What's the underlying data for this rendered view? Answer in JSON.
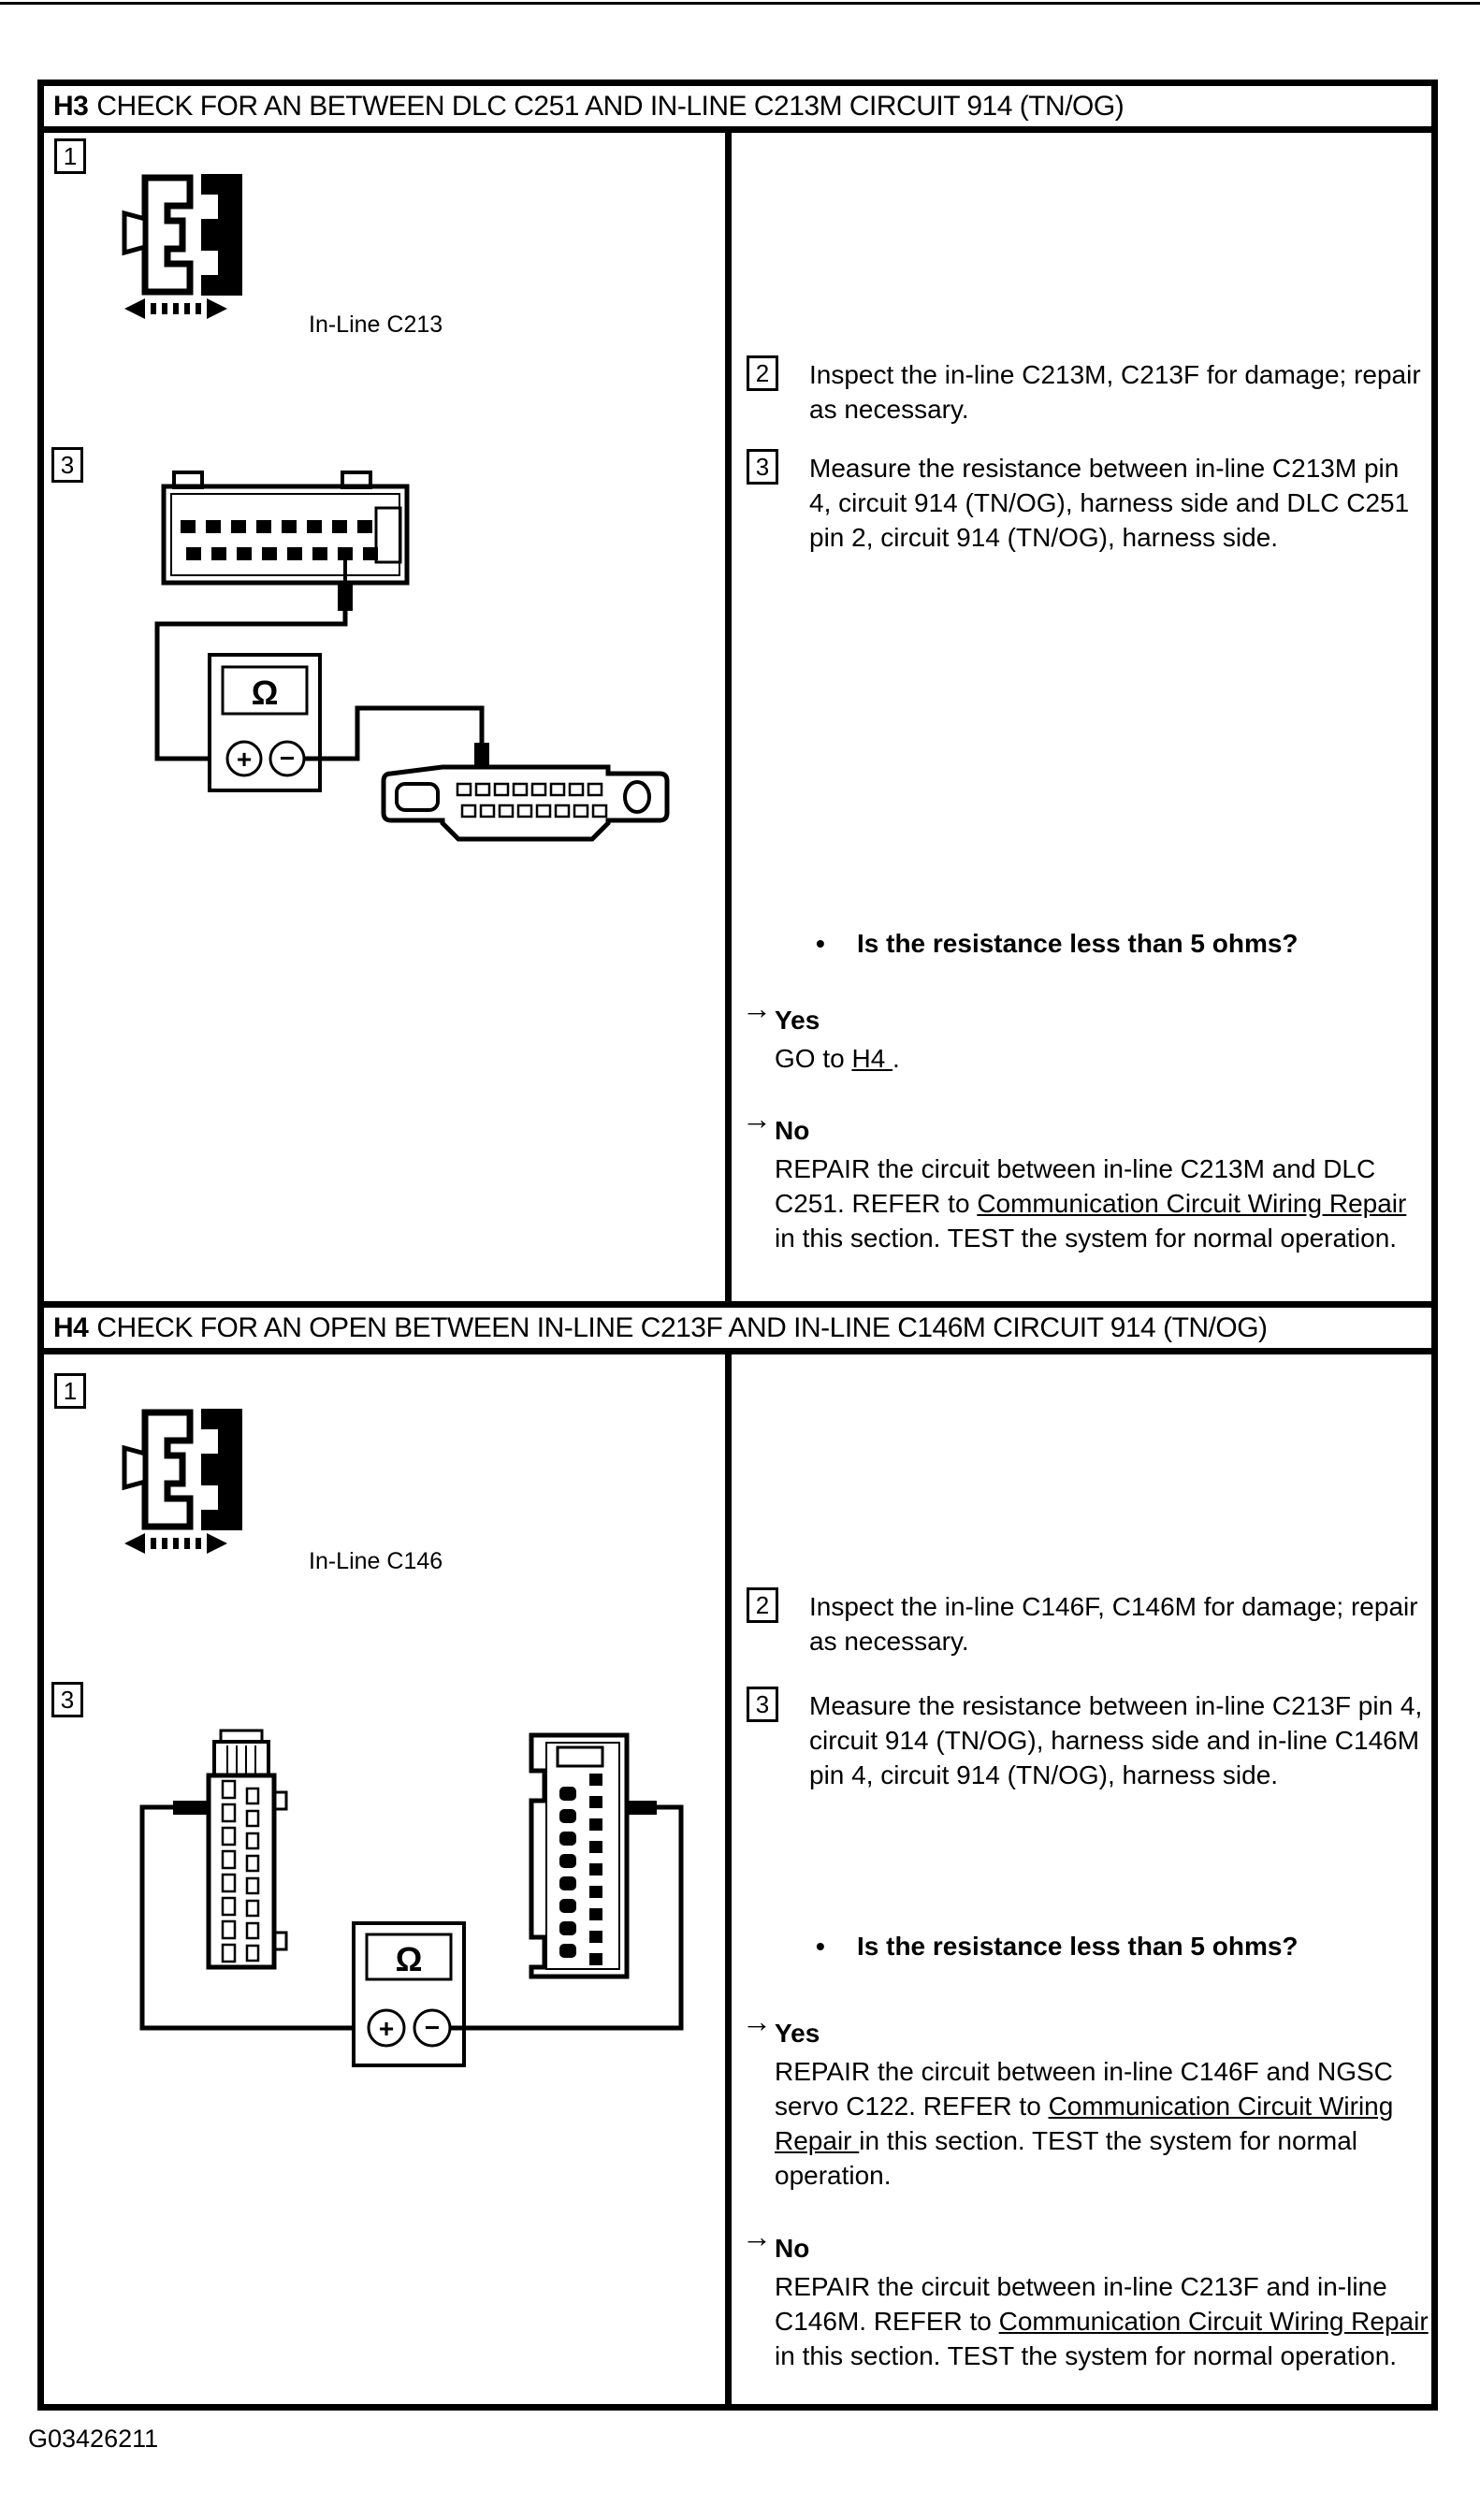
{
  "markers": {
    "bullet": "•",
    "arrow": "→"
  },
  "footer": {
    "figure_id": "G03426211"
  },
  "sections": [
    {
      "id": "H3",
      "title_label": "H3",
      "title": "CHECK FOR AN BETWEEN DLC C251 AND IN-LINE C213M CIRCUIT 914 (TN/OG)",
      "left": {
        "step1_number": "1",
        "step3_number": "3",
        "connector_label": "In-Line C213",
        "meter_symbol": "Ω",
        "meter_plus": "+",
        "meter_minus": "−"
      },
      "right": {
        "steps": [
          {
            "number": "2",
            "text": "Inspect the in-line C213M, C213F for damage; repair as necessary."
          },
          {
            "number": "3",
            "text": "Measure the resistance between in-line C213M pin 4, circuit 914 (TN/OG), harness side and DLC C251 pin 2, circuit 914 (TN/OG), harness side."
          }
        ],
        "question": "Is the resistance less than 5 ohms?",
        "yes_label": "Yes",
        "yes_pre": "GO to ",
        "yes_link": "H4 ",
        "yes_post": ".",
        "no_label": "No",
        "no_pre": "REPAIR the circuit between in-line C213M and DLC C251. REFER to ",
        "no_link": "Communication Circuit Wiring Repair ",
        "no_post": "in this section. TEST the system for normal operation."
      }
    },
    {
      "id": "H4",
      "title_label": "H4",
      "title": "CHECK FOR AN OPEN BETWEEN IN-LINE C213F AND IN-LINE C146M CIRCUIT 914 (TN/OG)",
      "left": {
        "step1_number": "1",
        "step3_number": "3",
        "connector_label": "In-Line C146",
        "meter_symbol": "Ω",
        "meter_plus": "+",
        "meter_minus": "−"
      },
      "right": {
        "steps": [
          {
            "number": "2",
            "text": "Inspect the in-line C146F, C146M for damage; repair as necessary."
          },
          {
            "number": "3",
            "text": "Measure the resistance between in-line C213F pin 4, circuit 914 (TN/OG), harness side and in-line C146M pin 4, circuit 914 (TN/OG), harness side."
          }
        ],
        "question": "Is the resistance less than 5 ohms?",
        "yes_label": "Yes",
        "yes_pre": "REPAIR the circuit between in-line C146F and NGSC servo C122. REFER to ",
        "yes_link": "Communication Circuit Wiring Repair ",
        "yes_post": "in this section. TEST the system for normal operation.",
        "no_label": "No",
        "no_pre": "REPAIR the circuit between in-line C213F and in-line C146M. REFER to ",
        "no_link": "Communication Circuit Wiring Repair ",
        "no_post": "in this section. TEST the system for normal operation."
      }
    }
  ]
}
